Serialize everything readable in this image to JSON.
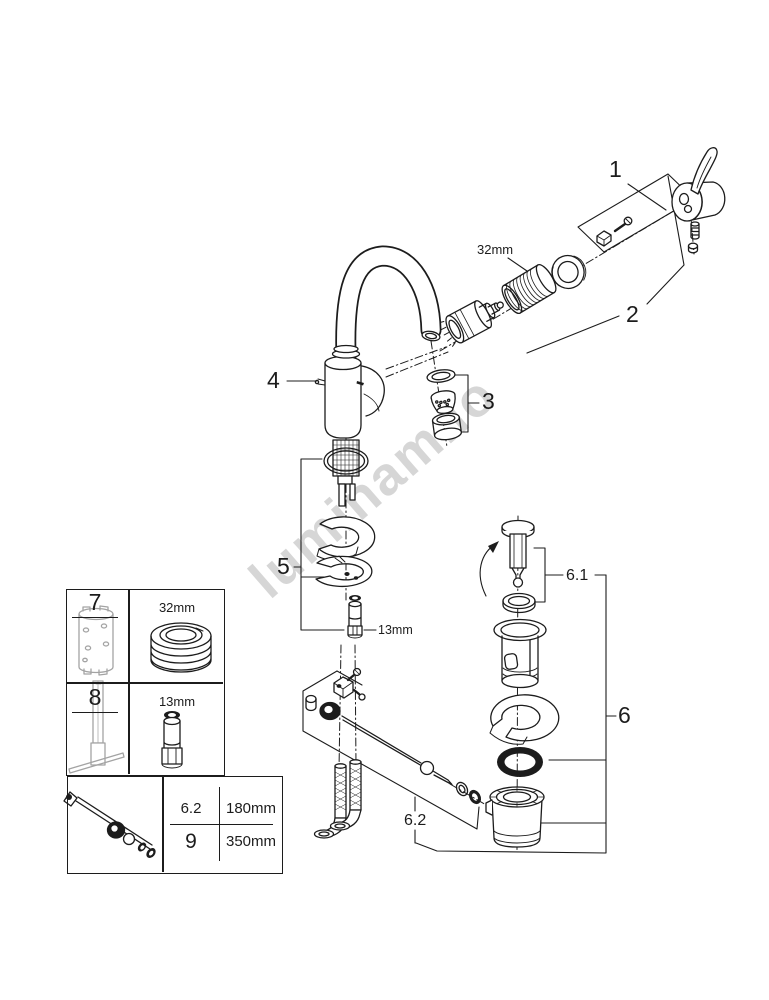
{
  "watermark": {
    "text": "luminam.io"
  },
  "diagram": {
    "callouts": {
      "c1": "1",
      "c2": "2",
      "c3": "3",
      "c4": "4",
      "c5": "5",
      "c6": "6",
      "c6_1": "6.1",
      "c6_2": "6.2"
    },
    "size_labels": {
      "cartridge_nut": "32mm",
      "mounting_stud": "13mm"
    }
  },
  "tools_table": {
    "rows": [
      {
        "tool": "7",
        "size": "32mm"
      },
      {
        "tool": "8",
        "size": "13mm"
      }
    ]
  },
  "lengths_table": {
    "rows": [
      {
        "ref": "6.2",
        "value": "180mm"
      },
      {
        "ref": "9",
        "value": "350mm"
      }
    ]
  },
  "colors": {
    "line": "#1c1c1c",
    "tool_gray": "#a3a3a3",
    "watermark": "#d6d6d6"
  }
}
